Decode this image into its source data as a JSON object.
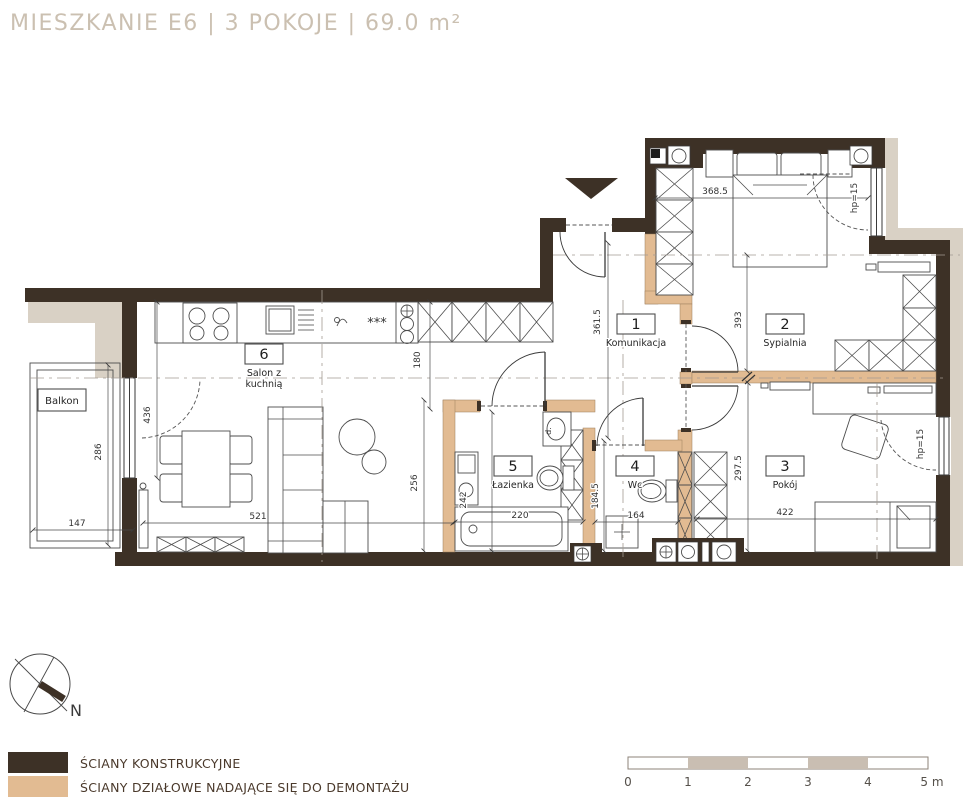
{
  "title": "MIESZKANIE E6 | 3 POKOJE | 69.0 m²",
  "colors": {
    "structural": "#3d3126",
    "partition": "#e2bb92",
    "exterior": "#d9d1c5",
    "scale_fill": "#c9beb2"
  },
  "rooms": {
    "r1": {
      "num": "1",
      "label": "Komunikacja"
    },
    "r2": {
      "num": "2",
      "label": "Sypialnia"
    },
    "r3": {
      "num": "3",
      "label": "Pokój"
    },
    "r4": {
      "num": "4",
      "label": "Wc"
    },
    "r5": {
      "num": "5",
      "label": "Łazienka"
    },
    "r6": {
      "num": "6",
      "label_line1": "Salon z",
      "label_line2": "kuchnią"
    }
  },
  "balcony_label": "Balkon",
  "dims": {
    "sypialnia_w": "368.5",
    "komunikacja_l": "361.5",
    "sypialnia_h": "393",
    "aneks": "180",
    "salon_l": "436",
    "balkon_h": "286",
    "balkon_w": "147",
    "salon_w": "521",
    "salon_r": "256",
    "lazienka_h": "242",
    "lazienka_w": "220",
    "wc_h": "184.5",
    "wc_w": "164",
    "pokoj_h": "297.5",
    "pokoj_w": "422",
    "parapet": "hp=15"
  },
  "kitchen": {
    "freezer_symbol": "***"
  },
  "bathroom": {
    "mark": "d."
  },
  "compass": {
    "north": "N"
  },
  "legend": [
    {
      "label": "ŚCIANY KONSTRUKCYJNE",
      "color": "#3d3126"
    },
    {
      "label": "ŚCIANY DZIAŁOWE NADAJĄCE SIĘ DO DEMONTAŻU",
      "color": "#e2bb92"
    }
  ],
  "scale_bar": {
    "ticks": [
      "0",
      "1",
      "2",
      "3",
      "4"
    ],
    "unit": "5 m"
  }
}
